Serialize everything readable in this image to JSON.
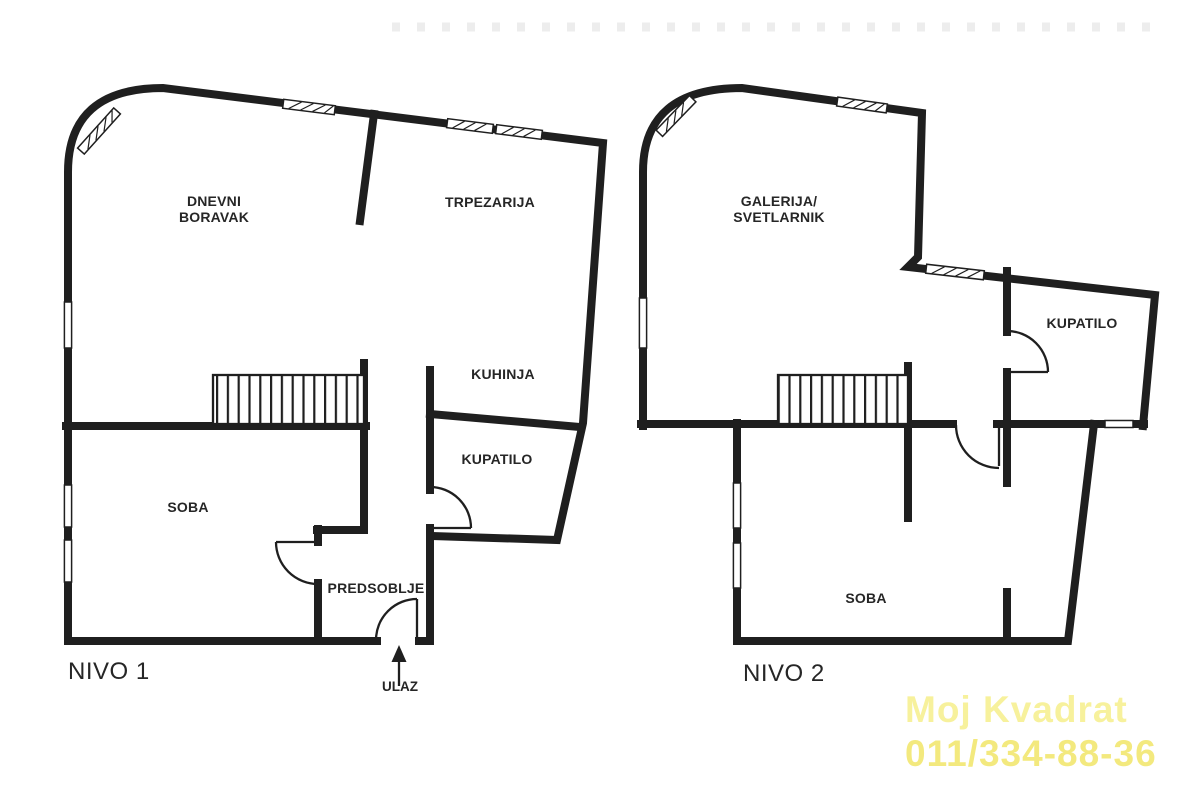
{
  "colors": {
    "wall": "#1f1f1f",
    "label": "#262626",
    "wm1": "#f7f19c",
    "wm2": "#f3e97e",
    "dots": "#ededed",
    "bg": "#ffffff"
  },
  "nivo1": {
    "title": "NIVO 1",
    "entrance_label": "ULAZ",
    "rooms": {
      "dnevni_line1": "DNEVNI",
      "dnevni_line2": "BORAVAK",
      "trpezarija": "TRPEZARIJA",
      "kuhinja": "KUHINJA",
      "kupatilo": "KUPATILO",
      "soba": "SOBA",
      "predsoblje": "PREDSOBLJE"
    }
  },
  "nivo2": {
    "title": "NIVO 2",
    "rooms": {
      "galerija_line1": "GALERIJA/",
      "galerija_line2": "SVETLARNIK",
      "kupatilo": "KUPATILO",
      "soba": "SOBA"
    }
  },
  "watermark": {
    "line1": "Moj Kvadrat",
    "line2": "011/334-88-36"
  }
}
